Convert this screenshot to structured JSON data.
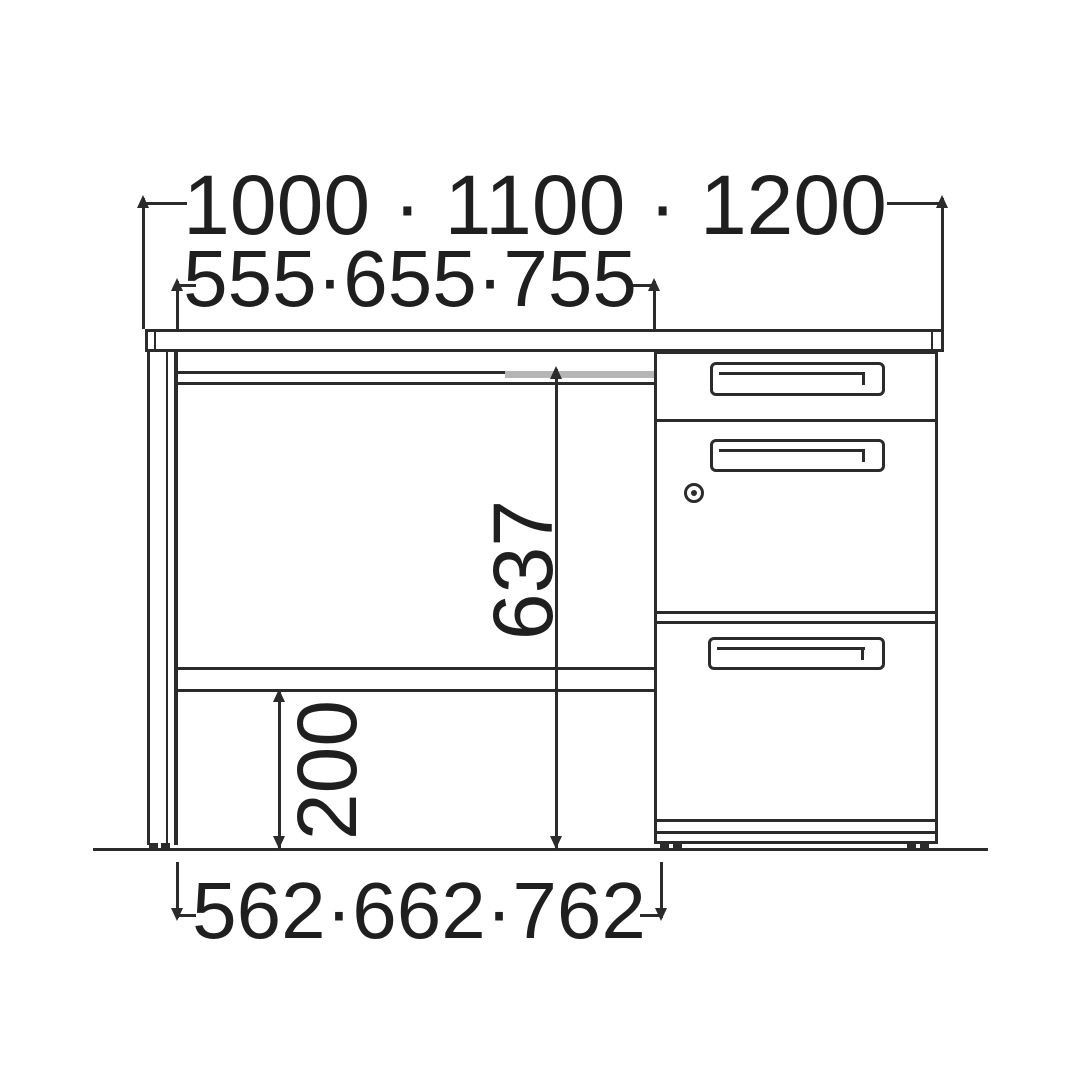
{
  "dimensions": {
    "top_width": "1000 · 1100 · 1200",
    "inner_width": "555·655·755",
    "height_main": "637",
    "height_lower": "200",
    "bottom_width": "562·662·762"
  },
  "colors": {
    "line": "#2b2b2b",
    "text": "#1f1f1f",
    "rail_highlight": "#b6b6b6",
    "background": "#ffffff"
  }
}
